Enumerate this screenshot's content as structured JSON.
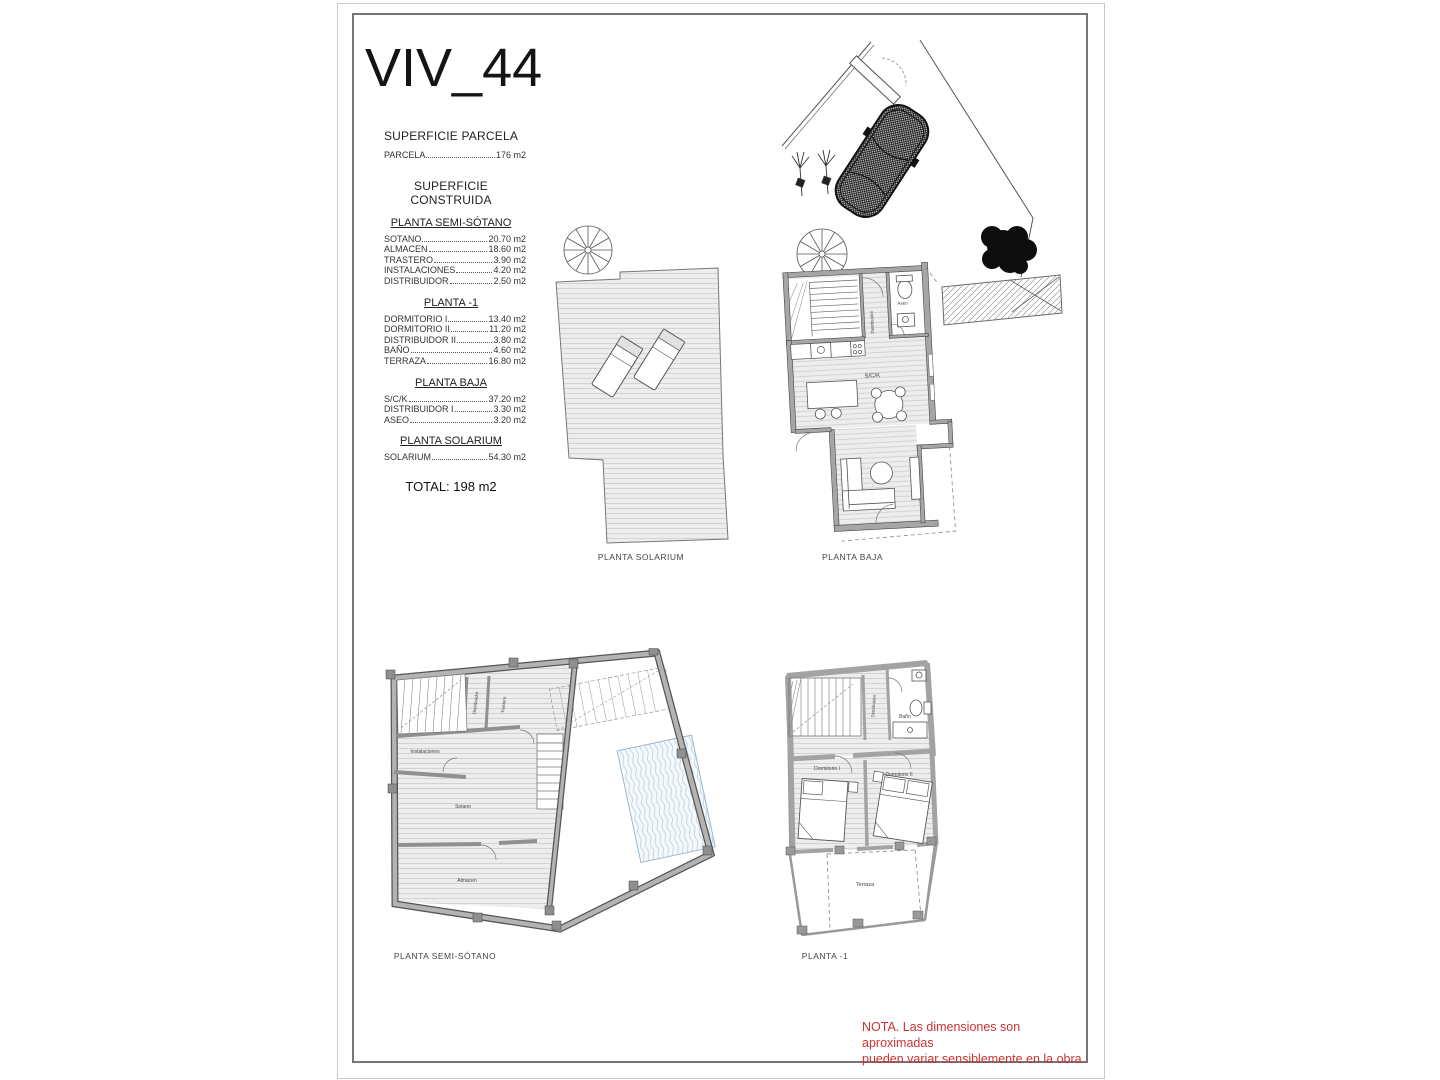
{
  "document": {
    "title": "VIV_44"
  },
  "surfaces": {
    "parcela": {
      "heading": "SUPERFICIE PARCELA",
      "rows": [
        {
          "label": "PARCELA",
          "value": "176 m2"
        }
      ]
    },
    "construida": {
      "heading": "SUPERFICIE CONSTRUIDA",
      "sections": [
        {
          "heading": "PLANTA SEMI-SÓTANO",
          "rows": [
            {
              "label": "SOTANO",
              "value": "20.70 m2"
            },
            {
              "label": "ALMACEN",
              "value": "18.60 m2"
            },
            {
              "label": "TRASTERO",
              "value": "3.90 m2"
            },
            {
              "label": "INSTALACIONES",
              "value": "4.20 m2"
            },
            {
              "label": "DISTRIBUIDOR",
              "value": "2.50 m2"
            }
          ]
        },
        {
          "heading": "PLANTA -1",
          "rows": [
            {
              "label": "DORMITORIO I",
              "value": "13.40 m2"
            },
            {
              "label": "DORMITORIO II",
              "value": "11.20 m2"
            },
            {
              "label": "DISTRIBUIDOR II",
              "value": "3.80 m2"
            },
            {
              "label": "BAÑO",
              "value": "4.60 m2"
            },
            {
              "label": "TERRAZA",
              "value": "16.80 m2"
            }
          ]
        },
        {
          "heading": "PLANTA BAJA",
          "rows": [
            {
              "label": "S/C/K",
              "value": "37.20 m2"
            },
            {
              "label": "DISTRIBUIDOR I",
              "value": "3.30 m2"
            },
            {
              "label": "ASEO",
              "value": "3.20 m2"
            }
          ]
        },
        {
          "heading": "PLANTA SOLARIUM",
          "rows": [
            {
              "label": "SOLARIUM",
              "value": "54.30 m2"
            }
          ]
        }
      ],
      "total": "TOTAL: 198 m2"
    }
  },
  "plans": {
    "solarium": {
      "caption": "PLANTA SOLARIUM"
    },
    "baja": {
      "caption": "PLANTA BAJA",
      "rooms": {
        "sck": "S/C/K",
        "distribuidor": "Distribuidor",
        "aseo": "Aseo"
      }
    },
    "semisotano": {
      "caption": "PLANTA SEMI-SÓTANO",
      "rooms": {
        "instalaciones": "Instalaciones",
        "distribuidor": "Distribuidor",
        "trastero": "Trastero",
        "sotano": "Sotano",
        "almacen": "Almacen"
      }
    },
    "planta1": {
      "caption": "PLANTA -1",
      "rooms": {
        "dormitorio1": "Dormitorio I",
        "dormitorio2": "Dormitorio II",
        "banio": "Baño",
        "distribuidor": "Distribuidor",
        "terraza": "Terraza"
      }
    }
  },
  "note": {
    "line1": "NOTA. Las dimensiones son aproximadas",
    "line2": "pueden variar sensiblemente en la obra",
    "color": "#cc3333"
  }
}
